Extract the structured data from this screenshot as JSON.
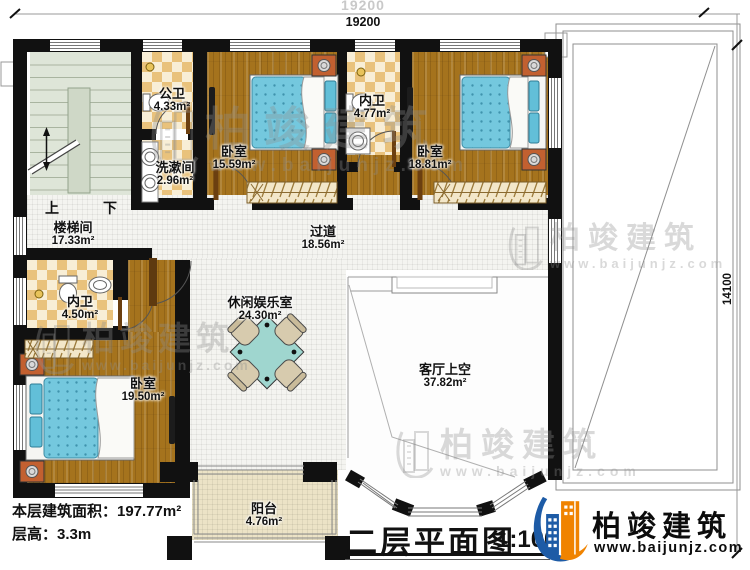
{
  "dimensions": {
    "total_width_faint": "19200",
    "total_width": "19200",
    "total_height": "14100"
  },
  "plan": {
    "rooms": [
      {
        "name": "楼梯间",
        "area": "17.33m²"
      },
      {
        "name": "公卫",
        "area": "4.33m²"
      },
      {
        "name": "洗漱间",
        "area": "2.96m²"
      },
      {
        "name": "卧室",
        "area": "15.59m²"
      },
      {
        "name": "内卫",
        "area": "4.77m²"
      },
      {
        "name": "卧室",
        "area": "18.81m²"
      },
      {
        "name": "过道",
        "area": "18.56m²"
      },
      {
        "name": "内卫",
        "area": "4.50m²"
      },
      {
        "name": "卧室",
        "area": "19.50m²"
      },
      {
        "name": "休闲娱乐室",
        "area": "24.30m²"
      },
      {
        "name": "客厅上空",
        "area": "37.82m²"
      },
      {
        "name": "阳台",
        "area": "4.76m²"
      }
    ],
    "stairs": {
      "up": "上",
      "down": "下"
    }
  },
  "footer": {
    "floor_area": "本层建筑面积：197.77m²",
    "floor_height": "层高：3.3m",
    "title": "二层平面图",
    "scale": "1:100"
  },
  "brand": {
    "name": "柏竣建筑",
    "website": "www.baijunjz.com"
  },
  "watermark": {
    "name": "柏竣建筑",
    "website": "www.baijunjz.com"
  },
  "colors": {
    "wall": "#111111",
    "wood": "#a5731d",
    "tile": "#e9c27c",
    "stairs": "#dee5d8",
    "mattress": "#74c8de",
    "table": "#9fd6cf",
    "balcony": "#ece3c6",
    "brand_blue": "#1d5ba6",
    "brand_orange": "#f08300"
  }
}
